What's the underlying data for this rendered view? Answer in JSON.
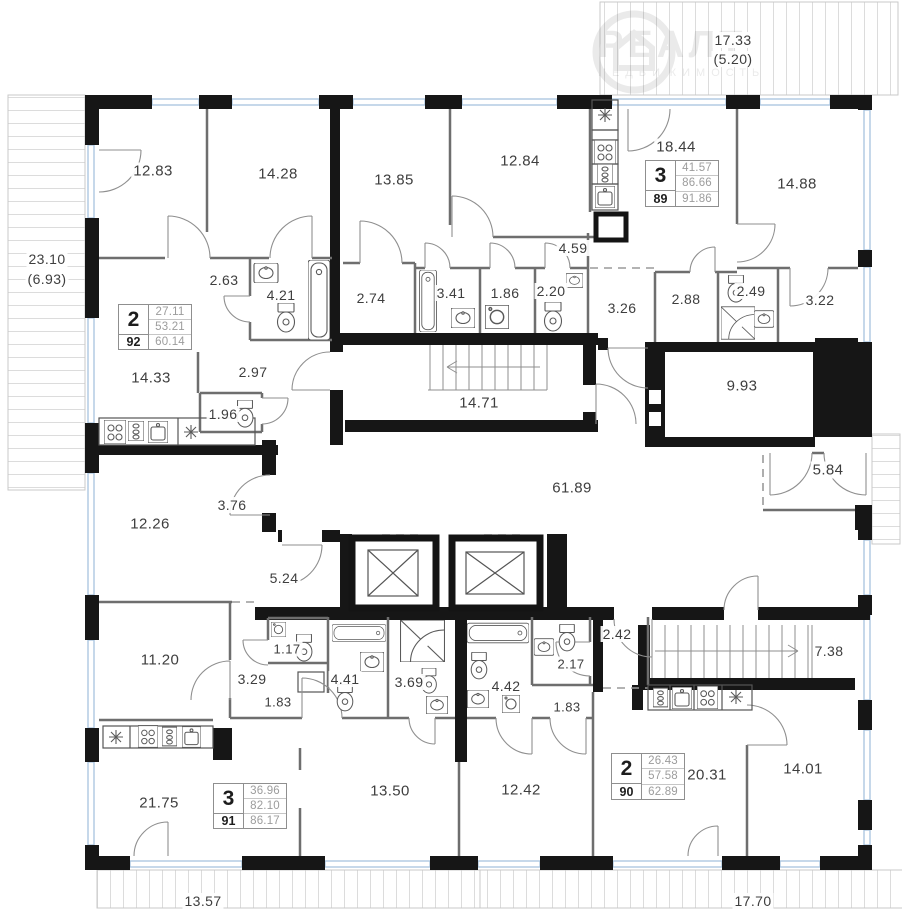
{
  "plan": {
    "watermark": {
      "brand": "РЕАЛТ",
      "sub": "НЕДВИЖИМОСТЬ"
    },
    "rooms": [
      {
        "area": "12.83"
      },
      {
        "area": "14.28"
      },
      {
        "area": "13.85"
      },
      {
        "area": "12.84"
      },
      {
        "area": "18.44"
      },
      {
        "area": "14.88"
      },
      {
        "area": "2.63"
      },
      {
        "area": "4.21"
      },
      {
        "area": "2.74"
      },
      {
        "area": "3.41"
      },
      {
        "area": "1.86"
      },
      {
        "area": "2.20"
      },
      {
        "area": "4.59"
      },
      {
        "area": "3.26"
      },
      {
        "area": "2.88"
      },
      {
        "area": "2.49"
      },
      {
        "area": "3.22"
      },
      {
        "area": "14.33"
      },
      {
        "area": "2.97"
      },
      {
        "area": "1.96"
      },
      {
        "area": "14.71"
      },
      {
        "area": "9.93"
      },
      {
        "area": "5.84"
      },
      {
        "area": "61.89"
      },
      {
        "area": "3.76"
      },
      {
        "area": "12.26"
      },
      {
        "area": "5.24"
      },
      {
        "area": "11.20"
      },
      {
        "area": "1.17"
      },
      {
        "area": "3.29"
      },
      {
        "area": "4.41"
      },
      {
        "area": "1.83"
      },
      {
        "area": "3.69"
      },
      {
        "area": "4.42"
      },
      {
        "area": "2.17"
      },
      {
        "area": "1.83"
      },
      {
        "area": "2.42"
      },
      {
        "area": "7.38"
      },
      {
        "area": "21.75"
      },
      {
        "area": "13.50"
      },
      {
        "area": "12.42"
      },
      {
        "area": "20.31"
      },
      {
        "area": "14.01"
      }
    ],
    "balconies": [
      {
        "line1": "23.10",
        "line2": "(6.93)"
      },
      {
        "line1": "17.33",
        "line2": "(5.20)"
      },
      {
        "line1": "13.57"
      },
      {
        "line1": "17.70"
      }
    ],
    "apartments": [
      {
        "rooms_count": "2",
        "area_living": "27.11",
        "area_main": "53.21",
        "number": "92",
        "area_total": "60.14"
      },
      {
        "rooms_count": "3",
        "area_living": "41.57",
        "area_main": "86.66",
        "number": "89",
        "area_total": "91.86"
      },
      {
        "rooms_count": "3",
        "area_living": "36.96",
        "area_main": "82.10",
        "number": "91",
        "area_total": "86.17"
      },
      {
        "rooms_count": "2",
        "area_living": "26.43",
        "area_main": "57.58",
        "number": "90",
        "area_total": "62.89"
      }
    ],
    "colors": {
      "wall": "#161616",
      "window": "#a7c4de",
      "hatch": "#dcdcdc",
      "label": "#3e3e3e",
      "value_muted": "#9c9c9c"
    }
  }
}
